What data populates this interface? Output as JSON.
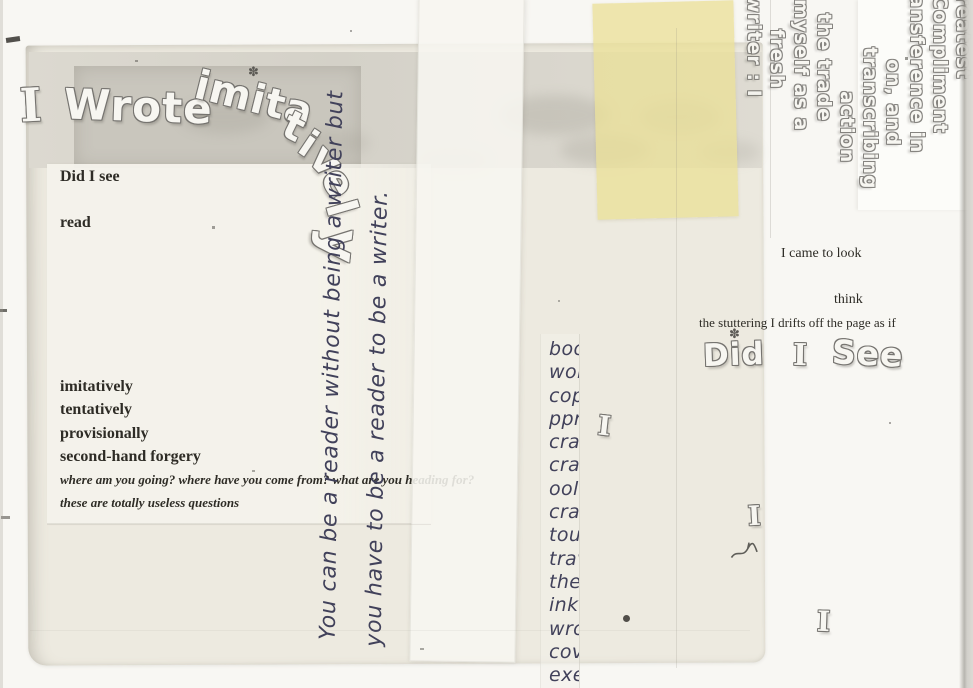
{
  "arc_title": {
    "head1": "I",
    "head2": "Wrote",
    "head3": "imita",
    "tail": [
      "t",
      "i",
      "v",
      "e",
      "l",
      "y"
    ],
    "star": "✽"
  },
  "left_block": {
    "line1": "Did I see",
    "line2": "read",
    "list": [
      "imitatively",
      "tentatively",
      "provisionally",
      "second-hand forgery"
    ],
    "italic1": "where am you going? where have you come from? what are you heading for?",
    "italic2": "these are totally useless questions"
  },
  "vertical_strip": {
    "line1": "You can be a reader without being a writer but",
    "line2": "you have to be a reader to be a writer."
  },
  "fragment_column": {
    "items": [
      "bool",
      "wor",
      "copy",
      "ppr",
      "crav",
      "cran",
      "ool",
      "crac",
      "touc",
      "trav",
      "the",
      "ink",
      "wro",
      "cov",
      "exer"
    ]
  },
  "right_block": {
    "line1": "I came to look",
    "line2": "think",
    "line3": "the stuttering I drifts off the page as if",
    "bubble_w1": "Did",
    "bubble_w2": "I",
    "bubble_w3": "See",
    "star": "✽"
  },
  "rotated_block": {
    "lines": [
      "reatest",
      "Compliment",
      "ansference in",
      "on,  and",
      "transcribing",
      "action",
      "the trade",
      "myself as a",
      "fresh",
      "writer : I"
    ]
  },
  "scattered": {
    "i1": "I",
    "i2": "I",
    "i3": "I"
  },
  "colors": {
    "page": "#f8f7f3",
    "main_sheet": "#ece9de",
    "gray_band": "#d6d3ca",
    "gray_band_dark": "#c9c6bd",
    "typed_sheet": "#f5f3eb",
    "strip": "#f7f6f0",
    "yellow_note": "#eae099",
    "typed_ink": "#2e2c26",
    "hand_ink": "#41415a",
    "bubble_outline": "#767470"
  }
}
